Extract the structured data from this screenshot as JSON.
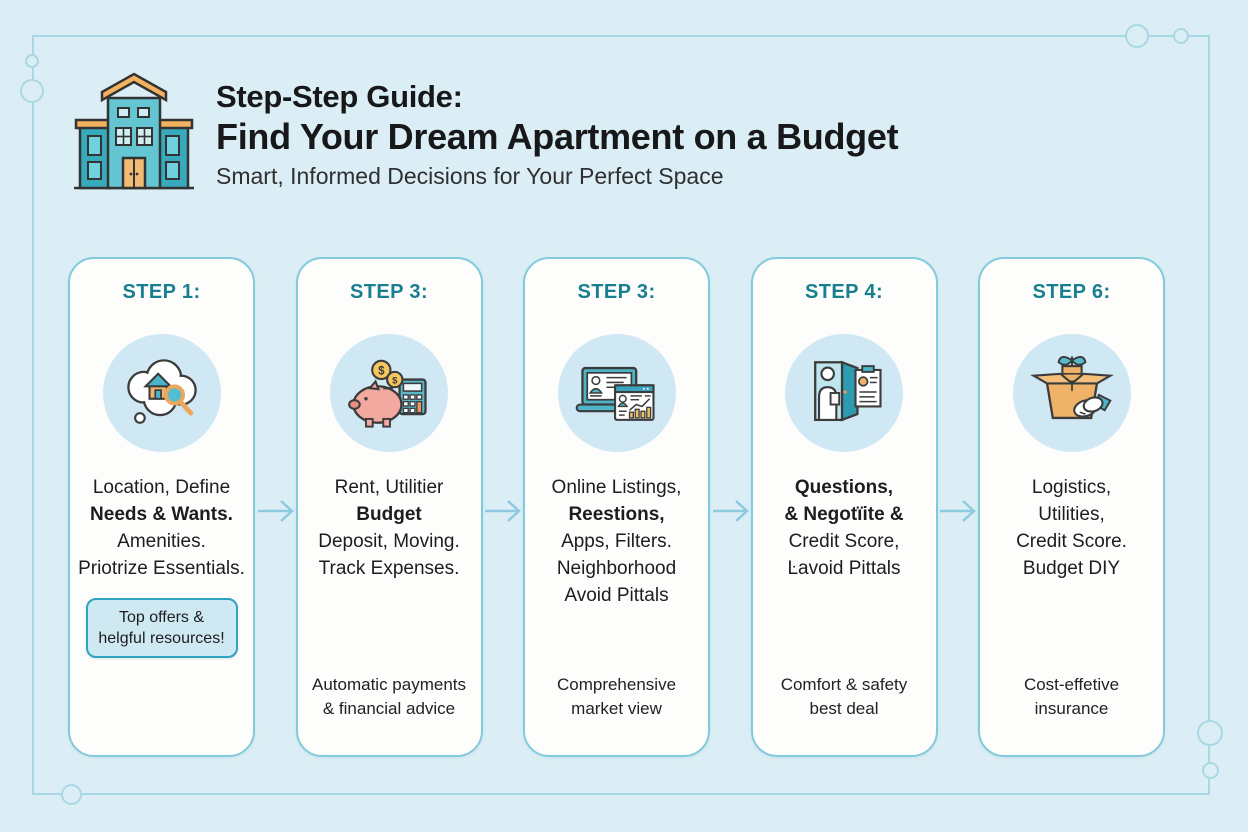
{
  "colors": {
    "bg": "#dceef5",
    "frame": "#a9d8e5",
    "card_bg": "#fdfdfc",
    "card_border": "#82cadd",
    "step_label": "#177f90",
    "text_dark": "#1d1d1f",
    "arrow": "#8ecadf",
    "badge_bg": "#cfe9f3",
    "badge_border": "#2fa3bf",
    "icon_circle": "#cfe8f4"
  },
  "header": {
    "icon": "apartment-building-icon",
    "title_line1": "Step-Step Guide:",
    "title_line2": "Find Your Dream Apartment on a Budget",
    "subtitle": "Smart, Informed Decisions for Your Perfect Space"
  },
  "steps": [
    {
      "label": "STEP 1:",
      "icon": "thought-bubble-house-search-icon",
      "lines": [
        "Location, Define",
        "Needs & Wants.",
        "Amenities.",
        "Priotrize Essentials."
      ],
      "badge": [
        "Top offers &",
        "helgful resources!"
      ],
      "footer": []
    },
    {
      "label": "STEP 3:",
      "icon": "piggy-bank-coins-calculator-icon",
      "lines": [
        "Rent, Utilitier",
        "Budget",
        "Deposit, Moving.",
        "Track Expenses."
      ],
      "badge": [],
      "footer": [
        "Automatic payments",
        "& financial advice"
      ]
    },
    {
      "label": "STEP 3:",
      "icon": "laptop-online-listings-icon",
      "lines": [
        "Online Listings,",
        "Reestions,",
        "Apps, Filters.",
        "Neighborhood",
        "Avoid Pittals"
      ],
      "badge": [],
      "footer": [
        "Comprehensive",
        "market view"
      ]
    },
    {
      "label": "STEP 4:",
      "icon": "apartment-viewing-checklist-icon",
      "lines": [
        "Questions,",
        "& Negotïite &",
        "Credit Score,",
        "Ŀavoid Pittals"
      ],
      "badge": [],
      "footer": [
        "Comfort & safety",
        "best deal"
      ]
    },
    {
      "label": "STEP 6:",
      "icon": "moving-box-handshake-icon",
      "lines": [
        "Logistics,",
        "Utilities,",
        "Credit Score.",
        "Budget DIY"
      ],
      "badge": [],
      "footer": [
        "Cost-effetive",
        "insurance"
      ]
    }
  ]
}
